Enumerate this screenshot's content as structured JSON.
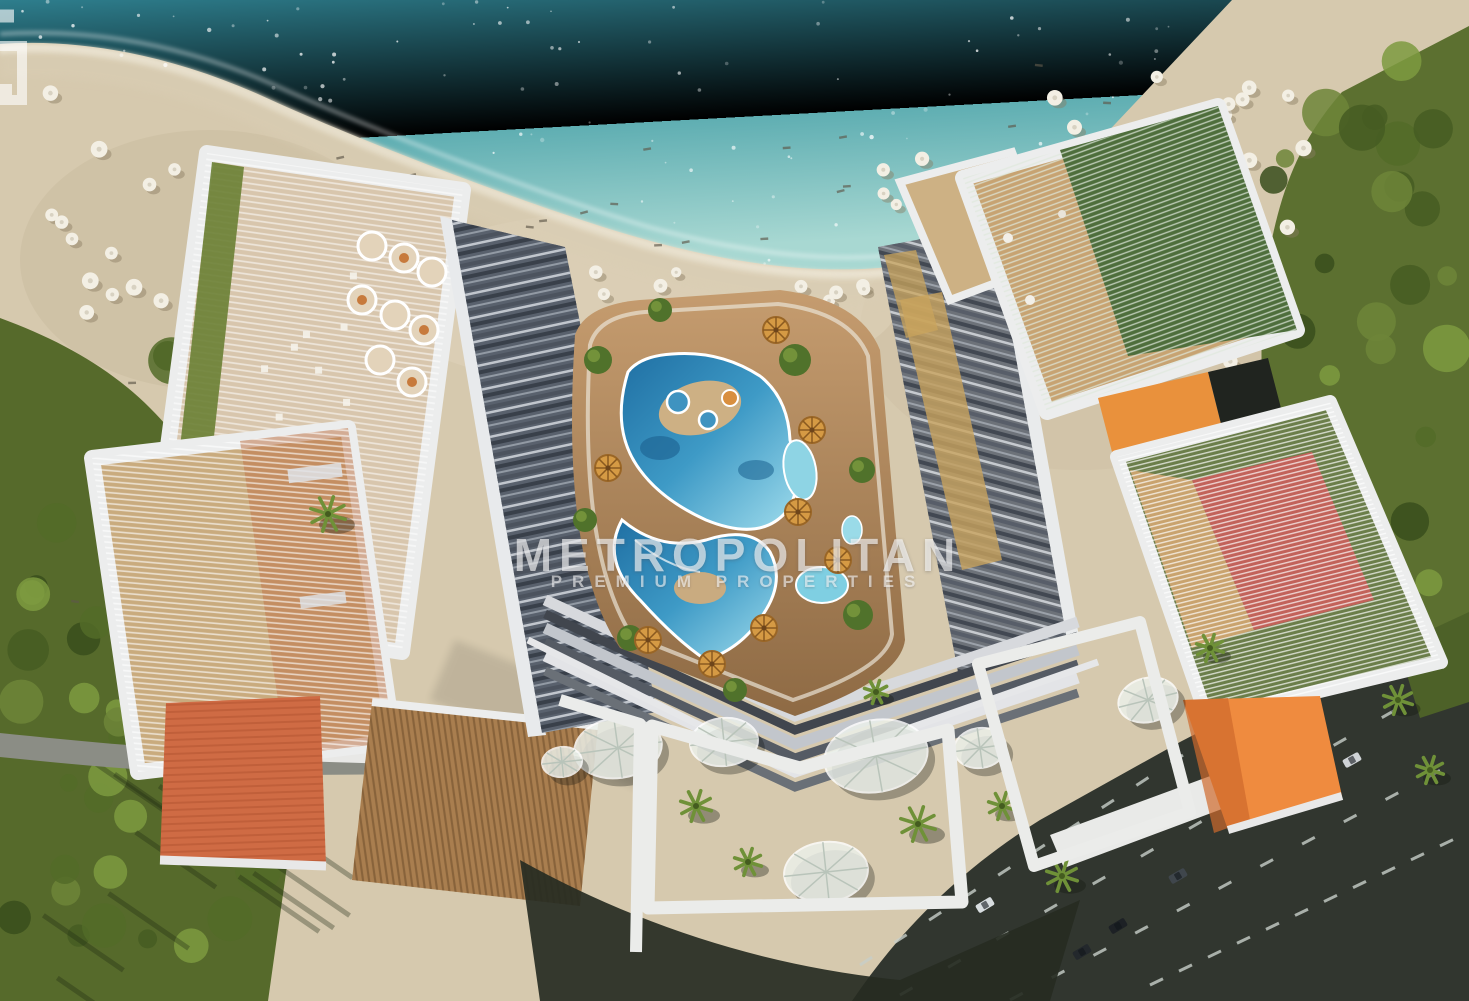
{
  "meta": {
    "type": "aerial-architectural-render",
    "subject": "Top-down aerial rendering of a beachfront resort residential complex with central lagoon pool",
    "width": 1469,
    "height": 1001
  },
  "watermark": {
    "brand": "METROPOLITAN",
    "tagline": "PREMIUM PROPERTIES",
    "logo": "metropolitan-m-monogram",
    "color": "#ffffff",
    "opacity": 0.62
  },
  "palette": {
    "ocean_deep": "#2e7e8d",
    "ocean_shallow": "#a8d8d2",
    "foam": "#f4f0e2",
    "sand": "#d6c9ae",
    "wet_sand": "#cbbda1",
    "vegetation": "#5c7030",
    "lawn": "#566a2b",
    "road_asphalt": "#31362f",
    "road_marking": "#c8cfc9",
    "frame_white": "#eceded",
    "facade_glass": "#59616d",
    "louver_tan": "#c9ab7e",
    "terracotta_roof": "#cf6b44",
    "orange_terrace": "#ef8b3f",
    "green_lattice": "#4e6e3c",
    "sport_court_red": "#c2625a",
    "pool_deep": "#1f6fa3",
    "pool_light": "#9fdcec",
    "pool_deck": "#c59c6f",
    "parasol_straw": "#d59a44",
    "canopy_white": "#edf2ec"
  },
  "scene": {
    "areas": [
      {
        "name": "ocean",
        "desc": "turquoise sea with sparkle and surf foam, upper band"
      },
      {
        "name": "shoreline-foam",
        "desc": "white wave foam line along wet sand"
      },
      {
        "name": "beach",
        "desc": "wide sandy beach with sunbathers and parasol clusters"
      },
      {
        "name": "beach-umbrellas",
        "desc": "clusters of white beach parasols with loungers"
      },
      {
        "name": "left-palm-grove",
        "desc": "green trees and lawn along left edge"
      },
      {
        "name": "right-palm-grove",
        "desc": "dense palm grove along right edge"
      },
      {
        "name": "coastal-road",
        "desc": "small access road and white walkway, bottom left"
      },
      {
        "name": "highway",
        "desc": "dark multi-lane road with dashed markings and cars, bottom right"
      },
      {
        "name": "resort-complex",
        "desc": "U-shaped mid-rise complex with white-framed roof terraces"
      },
      {
        "name": "rooftop-terrace-restaurant",
        "desc": "top-left white framed roof deck with round daybeds"
      },
      {
        "name": "rooftop-terrace-louvered",
        "desc": "left louvered pergola roof terrace"
      },
      {
        "name": "rooftop-terrace-lattice",
        "desc": "top-right green lattice pergola terrace"
      },
      {
        "name": "rooftop-terrace-court",
        "desc": "right pergola terrace over red sport court"
      },
      {
        "name": "terracotta-roof",
        "desc": "flat terracotta roof square, lower left"
      },
      {
        "name": "orange-terrace",
        "desc": "bright orange roof terrace, lower right"
      },
      {
        "name": "lagoon-pool",
        "desc": "organic lagoon swimming pool with islands in courtyard"
      },
      {
        "name": "pool-parasols",
        "desc": "straw parasols around the lagoon pool"
      },
      {
        "name": "stepped-terraces",
        "desc": "cascading balcony steps around courtyard"
      },
      {
        "name": "plaza-canopies",
        "desc": "round white membrane canopies over ground plaza"
      },
      {
        "name": "palm-trees",
        "desc": "scattered palms in plaza and groves"
      },
      {
        "name": "cars",
        "desc": "vehicles on the highway"
      }
    ]
  }
}
